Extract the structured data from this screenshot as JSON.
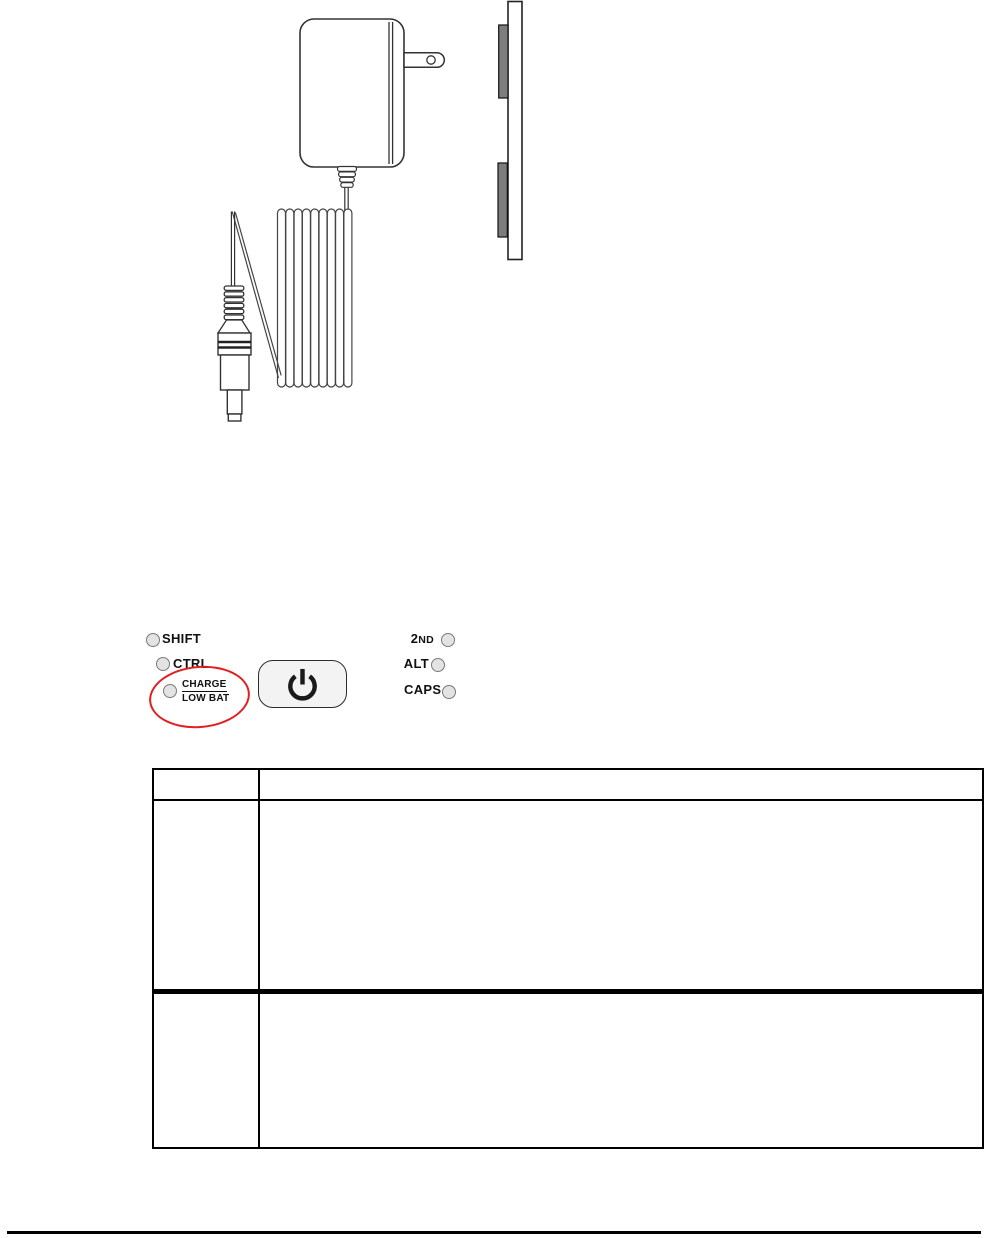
{
  "document": {
    "type": "device-manual-page"
  },
  "figures": {
    "adapter": {
      "front_view_name": "ac-power-adapter-front",
      "side_view_name": "ac-power-adapter-side-profile",
      "cord_name": "coiled-power-cord",
      "plug_name": "barrel-plug-connector",
      "prong_color": "#7d7d7d",
      "line_color": "#333333"
    },
    "indicator_panel": {
      "led_fill": "#e3e3e3",
      "led_border": "#7a7a7a",
      "highlight_ellipse_color": "#e02020",
      "power_button": {
        "icon": "power-icon"
      },
      "left_leds": [
        {
          "label": "SHIFT"
        },
        {
          "label": "CTRL"
        },
        {
          "label": "CHARGE",
          "label2": "LOW BAT",
          "highlighted": true
        }
      ],
      "right_leds": [
        {
          "label": "2ND",
          "label_main": "2",
          "label_small": "ND"
        },
        {
          "label": "ALT"
        },
        {
          "label": "CAPS"
        }
      ]
    }
  },
  "table": {
    "header": {
      "col1": "",
      "col2": ""
    },
    "rows": [
      {
        "col1": "",
        "col2": ""
      },
      {
        "col1": "",
        "col2": ""
      }
    ]
  },
  "footer": {
    "rule": ""
  }
}
